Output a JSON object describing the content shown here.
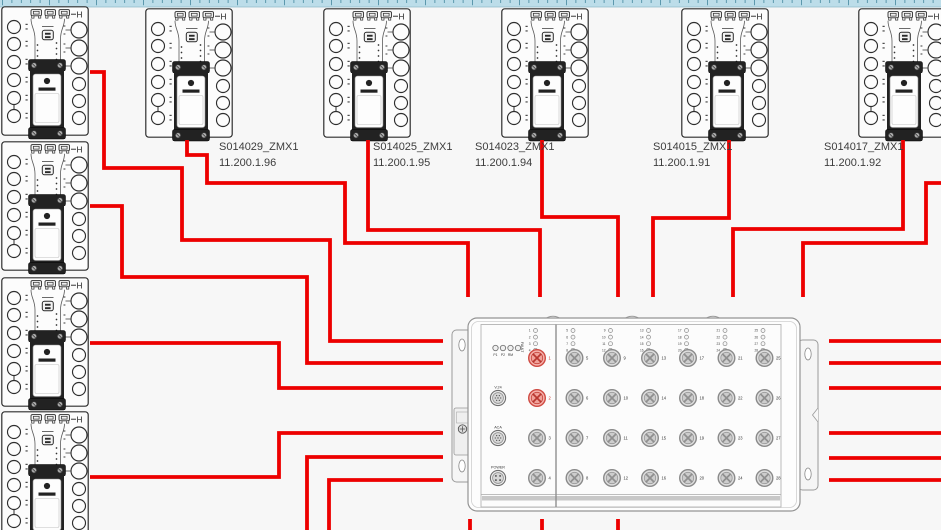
{
  "canvas": {
    "w": 941,
    "h": 530,
    "bg": "#f7f7f7"
  },
  "ruler": {
    "h": 7,
    "bg": "#bcdde9",
    "tick_color": "#45889e",
    "border_color": "#8fb9c9",
    "spacing": 9.4,
    "tall_every": 5
  },
  "colors": {
    "cable_red": "#ed0000",
    "outline": "#2e2e2e",
    "module_dark": "#222222",
    "label_text": "#3d3d3d",
    "port_red_fill": "#f5b1ab",
    "port_red_stroke": "#cf4a42",
    "port_gray_fill": "#dedede",
    "port_gray_stroke": "#8a8a8a"
  },
  "device_style": {
    "corner_mark": "H"
  },
  "device_labels": [
    {
      "name": "S014029_ZMX1",
      "ip": "11.200.1.96",
      "x": 219,
      "y": 140
    },
    {
      "name": "S014025_ZMX1",
      "ip": "11.200.1.95",
      "x": 373,
      "y": 140
    },
    {
      "name": "S014023_ZMX1",
      "ip": "11.200.1.94",
      "x": 475,
      "y": 140
    },
    {
      "name": "S014015_ZMX1",
      "ip": "11.200.1.91",
      "x": 653,
      "y": 140
    },
    {
      "name": "S014017_ZMX1",
      "ip": "11.200.1.92",
      "x": 824,
      "y": 140
    }
  ],
  "devices": [
    {
      "id": "zmx1-device-corner",
      "x": 1,
      "y": 6
    },
    {
      "id": "zmx1-device-top-2",
      "x": 145,
      "y": 8
    },
    {
      "id": "zmx1-device-top-3",
      "x": 323,
      "y": 8
    },
    {
      "id": "zmx1-device-top-4",
      "x": 501,
      "y": 8
    },
    {
      "id": "zmx1-device-top-5",
      "x": 681,
      "y": 8
    },
    {
      "id": "zmx1-device-top-6",
      "x": 858,
      "y": 8
    },
    {
      "id": "zmx1-device-left-2",
      "x": 1,
      "y": 141
    },
    {
      "id": "zmx1-device-left-3",
      "x": 1,
      "y": 277
    },
    {
      "id": "zmx1-device-left-4",
      "x": 1,
      "y": 411
    }
  ],
  "switch": {
    "x": 468,
    "y": 316,
    "status_leds": [
      "P1",
      "P2",
      "RM",
      "FAULT"
    ],
    "side_connectors": [
      "V.24",
      "ACA",
      "POWER"
    ],
    "ports_total": 28,
    "port_rows": 4,
    "port_cols": 7,
    "red_ports": [
      1,
      2
    ]
  },
  "cables": [
    "90,72 104,72 104,168 182,168 182,240 330,240 330,341 443,341",
    "90,206 122,206 122,277 307,277 307,363 443,363",
    "90,343 279,343 279,388 443,388",
    "90,477 279,477 279,433 443,433",
    "307,530 307,457 443,457",
    "329,530 329,480 443,480",
    "187,140 187,155 207,155 207,183 345,183 345,243 468,243 468,297",
    "368,140 368,230 540,230 540,297",
    "542,140 542,217 618,217 618,297",
    "729,140 729,218 653,218 653,297",
    "903,140 903,229 733,229 733,297",
    "941,183 926,183 926,243 803,243 803,297",
    "829,341 941,341",
    "829,363 941,363",
    "829,388 941,388",
    "829,433 941,433",
    "829,458 941,458",
    "829,480 941,480",
    "470,519 470,530",
    "542,519 542,530",
    "618,519 618,530"
  ]
}
